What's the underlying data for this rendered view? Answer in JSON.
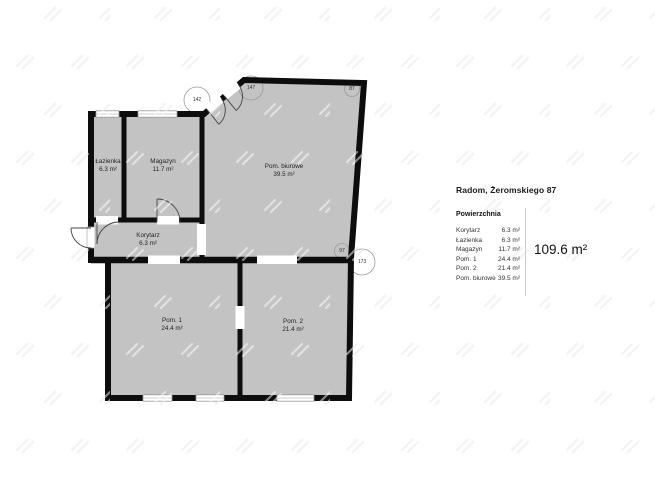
{
  "title": "Radom, Żeromskiego 87",
  "panel": {
    "section_label": "Powierzchnia",
    "rows": [
      {
        "name": "Korytarz",
        "area": "6.3 m²"
      },
      {
        "name": "Łazienka",
        "area": "6.3 m²"
      },
      {
        "name": "Magazyn",
        "area": "11.7 m²"
      },
      {
        "name": "Pom. 1",
        "area": "24.4 m²"
      },
      {
        "name": "Pom. 2",
        "area": "21.4 m²"
      },
      {
        "name": "Pom. biurowe",
        "area": "39.5 m²"
      }
    ],
    "total": "109.6 m²"
  },
  "plan": {
    "rooms": [
      {
        "name": "Łazienka",
        "area": "6.3 m²"
      },
      {
        "name": "Magazyn",
        "area": "11.7 m²"
      },
      {
        "name": "Pom. biurowe",
        "area": "39.5 m²"
      },
      {
        "name": "Korytarz",
        "area": "6.3 m²"
      },
      {
        "name": "Pom. 1",
        "area": "24.4 m²"
      },
      {
        "name": "Pom. 2",
        "area": "21.4 m²"
      }
    ],
    "angles": [
      {
        "value": "142"
      },
      {
        "value": "147"
      },
      {
        "value": "87"
      },
      {
        "value": "97"
      },
      {
        "value": "173"
      }
    ]
  },
  "colors": {
    "floor": "#c3c3c3",
    "wall": "#0d0d0d",
    "watermark": "#e7e7e7"
  }
}
